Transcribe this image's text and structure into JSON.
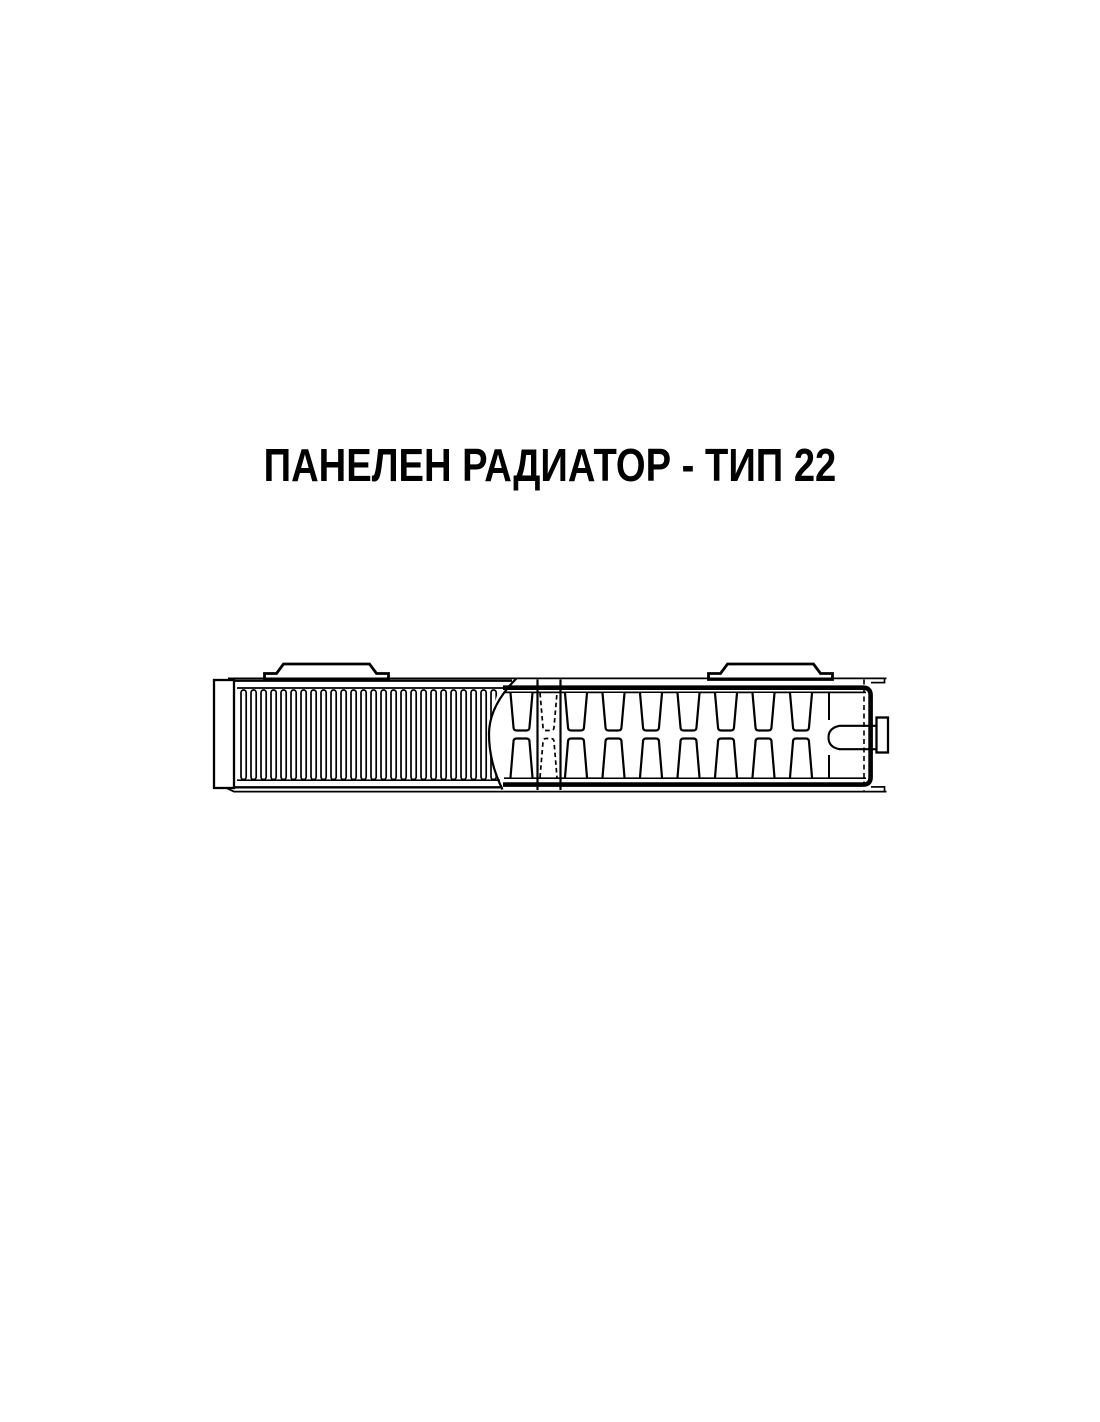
{
  "page": {
    "title": "ПАНЕЛЕН РАДИАТОР - ТИП 22",
    "background_color": "#ffffff",
    "ink_color": "#000000"
  },
  "diagram": {
    "ink": "#000000",
    "paper": "#ffffff",
    "geometry": {
      "cap": {
        "x": 214,
        "y": 680,
        "w": 20,
        "h": 108,
        "stroke": 2.3
      },
      "top_hairline": {
        "x1": 228,
        "y": 678.4,
        "x2": 886.5,
        "stroke": 1.8
      },
      "bottom_lip": {
        "x0": 226,
        "y0": 787.8,
        "x1": 234,
        "y": 791.6,
        "x2": 886.5,
        "stroke": 1.8
      },
      "panel": {
        "x1": 234,
        "outer_top_y": 680.7,
        "outer_top_x2": 512,
        "inner_top_y": 688.0,
        "inner_top_x2": 506,
        "inner_bottom_y": 780.2,
        "inner_bottom_x2": 500,
        "outer_bottom_y": 787.3,
        "outer_bottom_x2": 502,
        "outer_stroke": 2.3,
        "inner_stroke": 1.7
      },
      "fins": {
        "first_x": 241,
        "pitch": 10,
        "count": 27,
        "width": 5.2,
        "top": 690,
        "bottom": 779.5,
        "rx": 2.6,
        "stroke": 1.7
      },
      "cut_curve": {
        "d": "M 516.5 678.4 Q 489 706 489 734 Q 489 762 502.5 789.5",
        "stroke": 2.2
      },
      "clip_d": "M 214 650 L 516.5 650 Q 489 706 489 734 Q 489 762 502.5 795 L 214 795 Z",
      "brackets": [
        {
          "cx": 326.5
        },
        {
          "cx": 770.5
        }
      ],
      "bracket_shape": {
        "base_y": 679.5,
        "foot_y": 673.5,
        "top_y": 664,
        "half_base": 62,
        "half_foot": 50,
        "half_top": 43,
        "stroke": 2.8
      },
      "band": {
        "x1": 503,
        "x2": 863,
        "top_y": 687.7,
        "bottom_y": 784.6,
        "thick": 4.6,
        "corner_r": 7.5,
        "edge_x": 870.6
      },
      "slot_lines": {
        "top_y": 692.4,
        "bottom_y": 778.2,
        "x1": 504,
        "x2": 866,
        "stroke": 1.7
      },
      "slots": {
        "solid_x": [
          510.5,
          565,
          602.5,
          640,
          677.5,
          715,
          752.5,
          790
        ],
        "width": 22,
        "taper": 3,
        "r": 3.2,
        "top_open_y": 693,
        "top_closed_y": 730.5,
        "bot_closed_y": 738.5,
        "bot_open_y": 777.5,
        "stroke": 2.2,
        "dashed_x": 540,
        "dashed_width": 17,
        "dash": "4.5 3.2",
        "dashed_stroke": 1.7
      },
      "seam": {
        "x": [
          537.5,
          560.5
        ],
        "y1": 679.5,
        "y2": 790,
        "stroke": 2.2
      },
      "hidden_line": {
        "x": 864,
        "y1": 679.5,
        "y2": 790.5,
        "dash": "5 3.5",
        "stroke": 1.6
      },
      "arc": {
        "d": "M 839.5 725.8 Q 828.5 728 828.5 737.5 Q 828.5 747.2 839.5 749.2",
        "stroke": 2.1,
        "stubs": [
          [
            829,
            693,
            829,
            720
          ],
          [
            829,
            755,
            829,
            777.5
          ]
        ],
        "stub_stroke": 2.0
      },
      "channel": {
        "y1": 725.8,
        "y2": 749.2,
        "x1": 839,
        "x2": 876.5,
        "stroke": 2.2
      },
      "boss": {
        "x": 876.5,
        "y": 717.5,
        "w": 11.5,
        "h": 35,
        "stroke": 2.3
      },
      "stub_top": {
        "y": 682.6,
        "x1": 871,
        "x2": 884.5,
        "cap_y1": 677.5,
        "cap_y2": 683.5,
        "stroke": 1.7
      },
      "stub_bottom": {
        "y": 786.9,
        "x1": 871,
        "x2": 884.5,
        "cap_y1": 786.0,
        "cap_y2": 792.4,
        "stroke": 1.7
      }
    }
  }
}
